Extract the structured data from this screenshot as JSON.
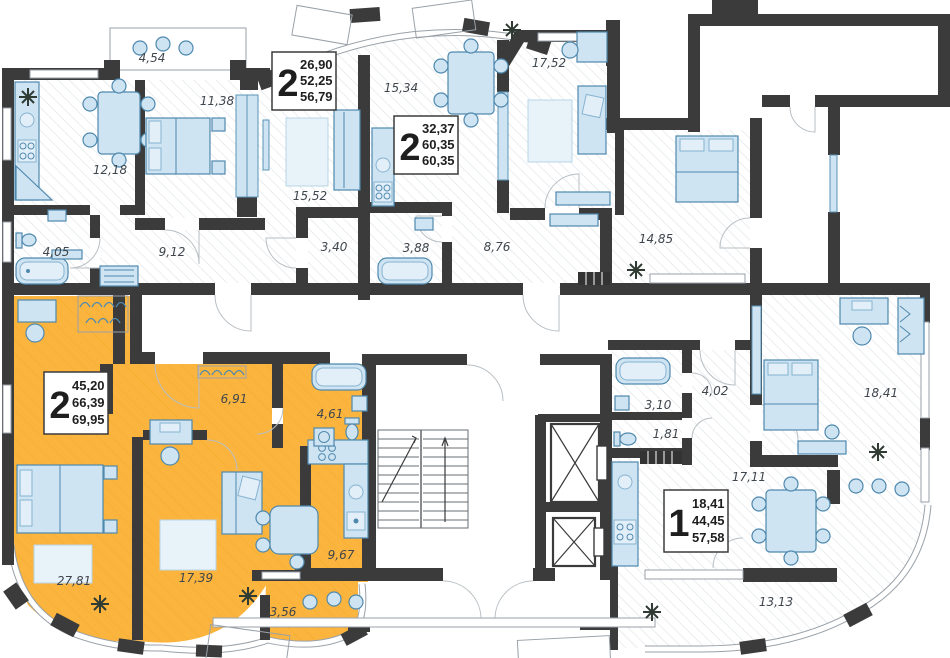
{
  "plan": {
    "colors": {
      "highlight": "#fbb53e",
      "wall": "#3b3b3b",
      "furniture": "#cfe4f2",
      "hatch": "#e2e6e9"
    },
    "apartments": [
      {
        "id": "apt-top-left",
        "rooms_count": "2",
        "areas": [
          "26,90",
          "52,25",
          "56,79"
        ],
        "highlighted": false
      },
      {
        "id": "apt-top-middle",
        "rooms_count": "2",
        "areas": [
          "32,37",
          "60,35",
          "60,35"
        ],
        "highlighted": false
      },
      {
        "id": "apt-bottom-left",
        "rooms_count": "2",
        "areas": [
          "45,20",
          "66,39",
          "69,95"
        ],
        "highlighted": true
      },
      {
        "id": "apt-right",
        "rooms_count": "1",
        "areas": [
          "18,41",
          "44,45",
          "57,58"
        ],
        "highlighted": false
      }
    ],
    "rooms": [
      {
        "name": "balcony",
        "area": "4,54"
      },
      {
        "name": "bedroom",
        "area": "11,38"
      },
      {
        "name": "kitchen",
        "area": "12,18"
      },
      {
        "name": "bathroom",
        "area": "4,05"
      },
      {
        "name": "hallway",
        "area": "9,12"
      },
      {
        "name": "living-room",
        "area": "15,52"
      },
      {
        "name": "hallway",
        "area": "3,40"
      },
      {
        "name": "kitchen-living",
        "area": "15,34"
      },
      {
        "name": "bathroom",
        "area": "3,88"
      },
      {
        "name": "hallway",
        "area": "8,76"
      },
      {
        "name": "living-room",
        "area": "17,52"
      },
      {
        "name": "bedroom",
        "area": "14,85"
      },
      {
        "name": "bedroom",
        "area": "27,81"
      },
      {
        "name": "hallway",
        "area": "6,91"
      },
      {
        "name": "bathroom",
        "area": "4,61"
      },
      {
        "name": "living-room",
        "area": "17,39"
      },
      {
        "name": "kitchen",
        "area": "9,67"
      },
      {
        "name": "balcony",
        "area": "3,56"
      },
      {
        "name": "room",
        "area": "18,41"
      },
      {
        "name": "hallway",
        "area": "4,02"
      },
      {
        "name": "bathroom",
        "area": "3,10"
      },
      {
        "name": "wc",
        "area": "1,81"
      },
      {
        "name": "kitchen-living",
        "area": "17,11"
      },
      {
        "name": "balcony",
        "area": "13,13"
      }
    ]
  }
}
